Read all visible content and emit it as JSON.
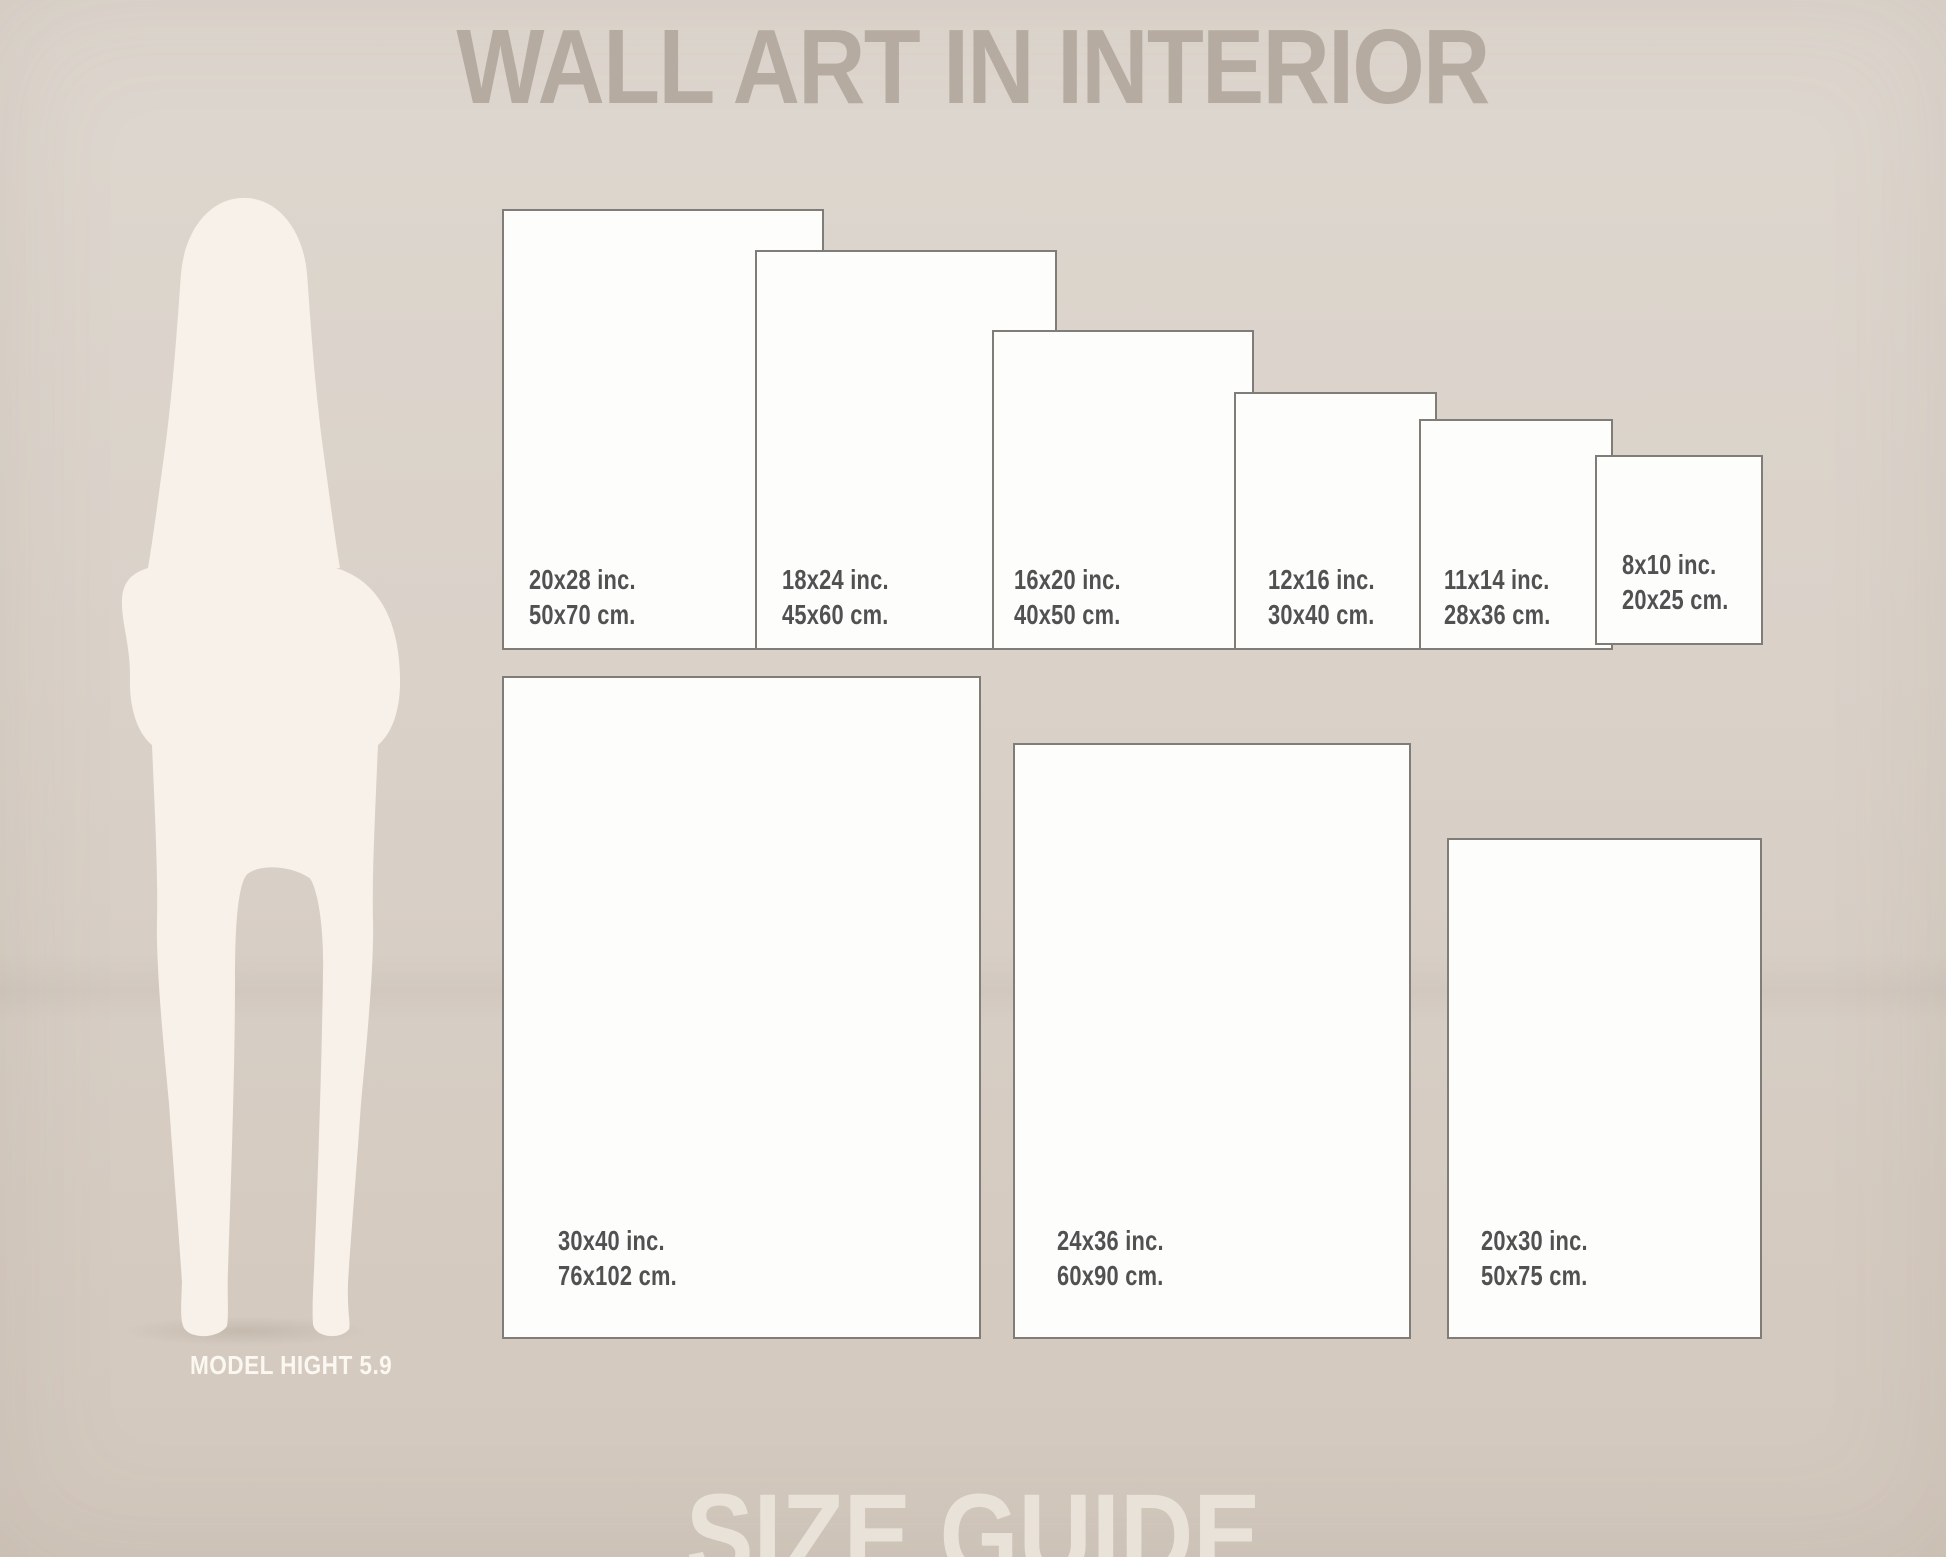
{
  "page": {
    "title": "WALL ART IN INTERIOR",
    "footer": "SIZE GUIDE"
  },
  "model": {
    "caption": "MODEL HIGHT 5.9"
  },
  "frames": {
    "row1": [
      {
        "inches": "20x28 inc.",
        "cm": "50x70 cm."
      },
      {
        "inches": "18x24 inc.",
        "cm": "45x60 cm."
      },
      {
        "inches": "16x20 inc.",
        "cm": "40x50 cm."
      },
      {
        "inches": "12x16 inc.",
        "cm": "30x40 cm."
      },
      {
        "inches": "11x14 inc.",
        "cm": "28x36 cm."
      },
      {
        "inches": "8x10 inc.",
        "cm": "20x25 cm."
      }
    ],
    "row2": [
      {
        "inches": "30x40 inc.",
        "cm": "76x102 cm."
      },
      {
        "inches": "24x36 inc.",
        "cm": "60x90 cm."
      },
      {
        "inches": "20x30 inc.",
        "cm": "50x75 cm."
      }
    ]
  },
  "colors": {
    "background_top": "#ded7cf",
    "background_bottom": "#d2c8bd",
    "title_text": "#b5aba1",
    "footer_text": "#e9e2d8",
    "frame_fill": "#fdfdfb",
    "frame_border": "#807d79",
    "label_text": "#515151",
    "silhouette": "#f7f1ea",
    "caption_text": "#fbf7f1"
  }
}
